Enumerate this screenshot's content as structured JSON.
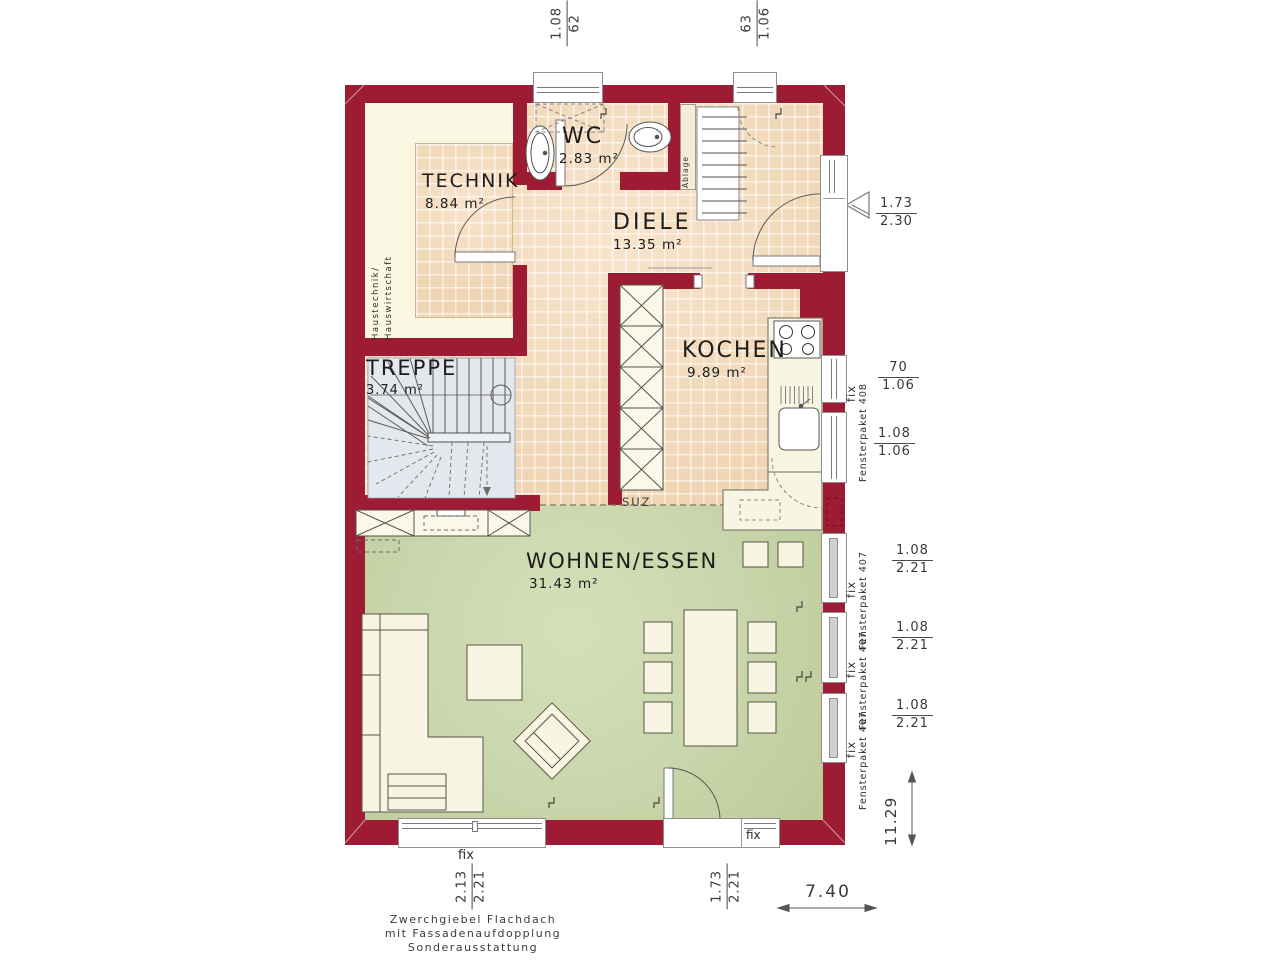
{
  "colors": {
    "wall": "#9d1c33",
    "tile_floor": "#f1d8ba",
    "cream_floor": "#faf7e2",
    "green_floor": "#c9d5aa",
    "stair_floor": "#e4e8ee",
    "furniture": "#f8f6e3"
  },
  "rooms": {
    "technik": {
      "name": "TECHNIK",
      "area": "8.84 m²"
    },
    "wc": {
      "name": "WC",
      "area": "2.83 m²"
    },
    "diele": {
      "name": "DIELE",
      "area": "13.35 m²"
    },
    "kochen": {
      "name": "KOCHEN",
      "area": "9.89 m²"
    },
    "treppe": {
      "name": "TREPPE",
      "area": "3.74 m²"
    },
    "wohnen_essen": {
      "name": "WOHNEN/ESSEN",
      "area": "31.43 m²"
    }
  },
  "labels": {
    "haustechnik_line1": "Haustechnik/",
    "haustechnik_line2": "Hauswirtschaft",
    "ablage": "Ablage",
    "suz": "SUZ",
    "fix": "fix",
    "fensterpaket_408": "Fensterpaket 408",
    "fensterpaket_407": "Fensterpaket 407"
  },
  "dimensions": {
    "top_window_left": {
      "a": "1.08",
      "b": "62"
    },
    "top_window_right": {
      "a": "63",
      "b": "1.06"
    },
    "entrance_door": {
      "a": "1.73",
      "b": "2.30"
    },
    "kitchen_window_upper": {
      "a": "70",
      "b": "1.06"
    },
    "kitchen_window_lower": {
      "a": "1.08",
      "b": "1.06"
    },
    "living_windows": [
      {
        "a": "1.08",
        "b": "2.21"
      },
      {
        "a": "1.08",
        "b": "2.21"
      },
      {
        "a": "1.08",
        "b": "2.21"
      }
    ],
    "bottom_window": {
      "a": "2.13",
      "b": "2.21"
    },
    "bottom_door": {
      "a": "1.73",
      "b": "2.21"
    },
    "total_depth": "11.29",
    "total_width": "7.40"
  },
  "caption": {
    "line1": "Zwerchgiebel Flachdach",
    "line2": "mit Fassadenaufdopplung",
    "line3": "Sonderausstattung"
  }
}
